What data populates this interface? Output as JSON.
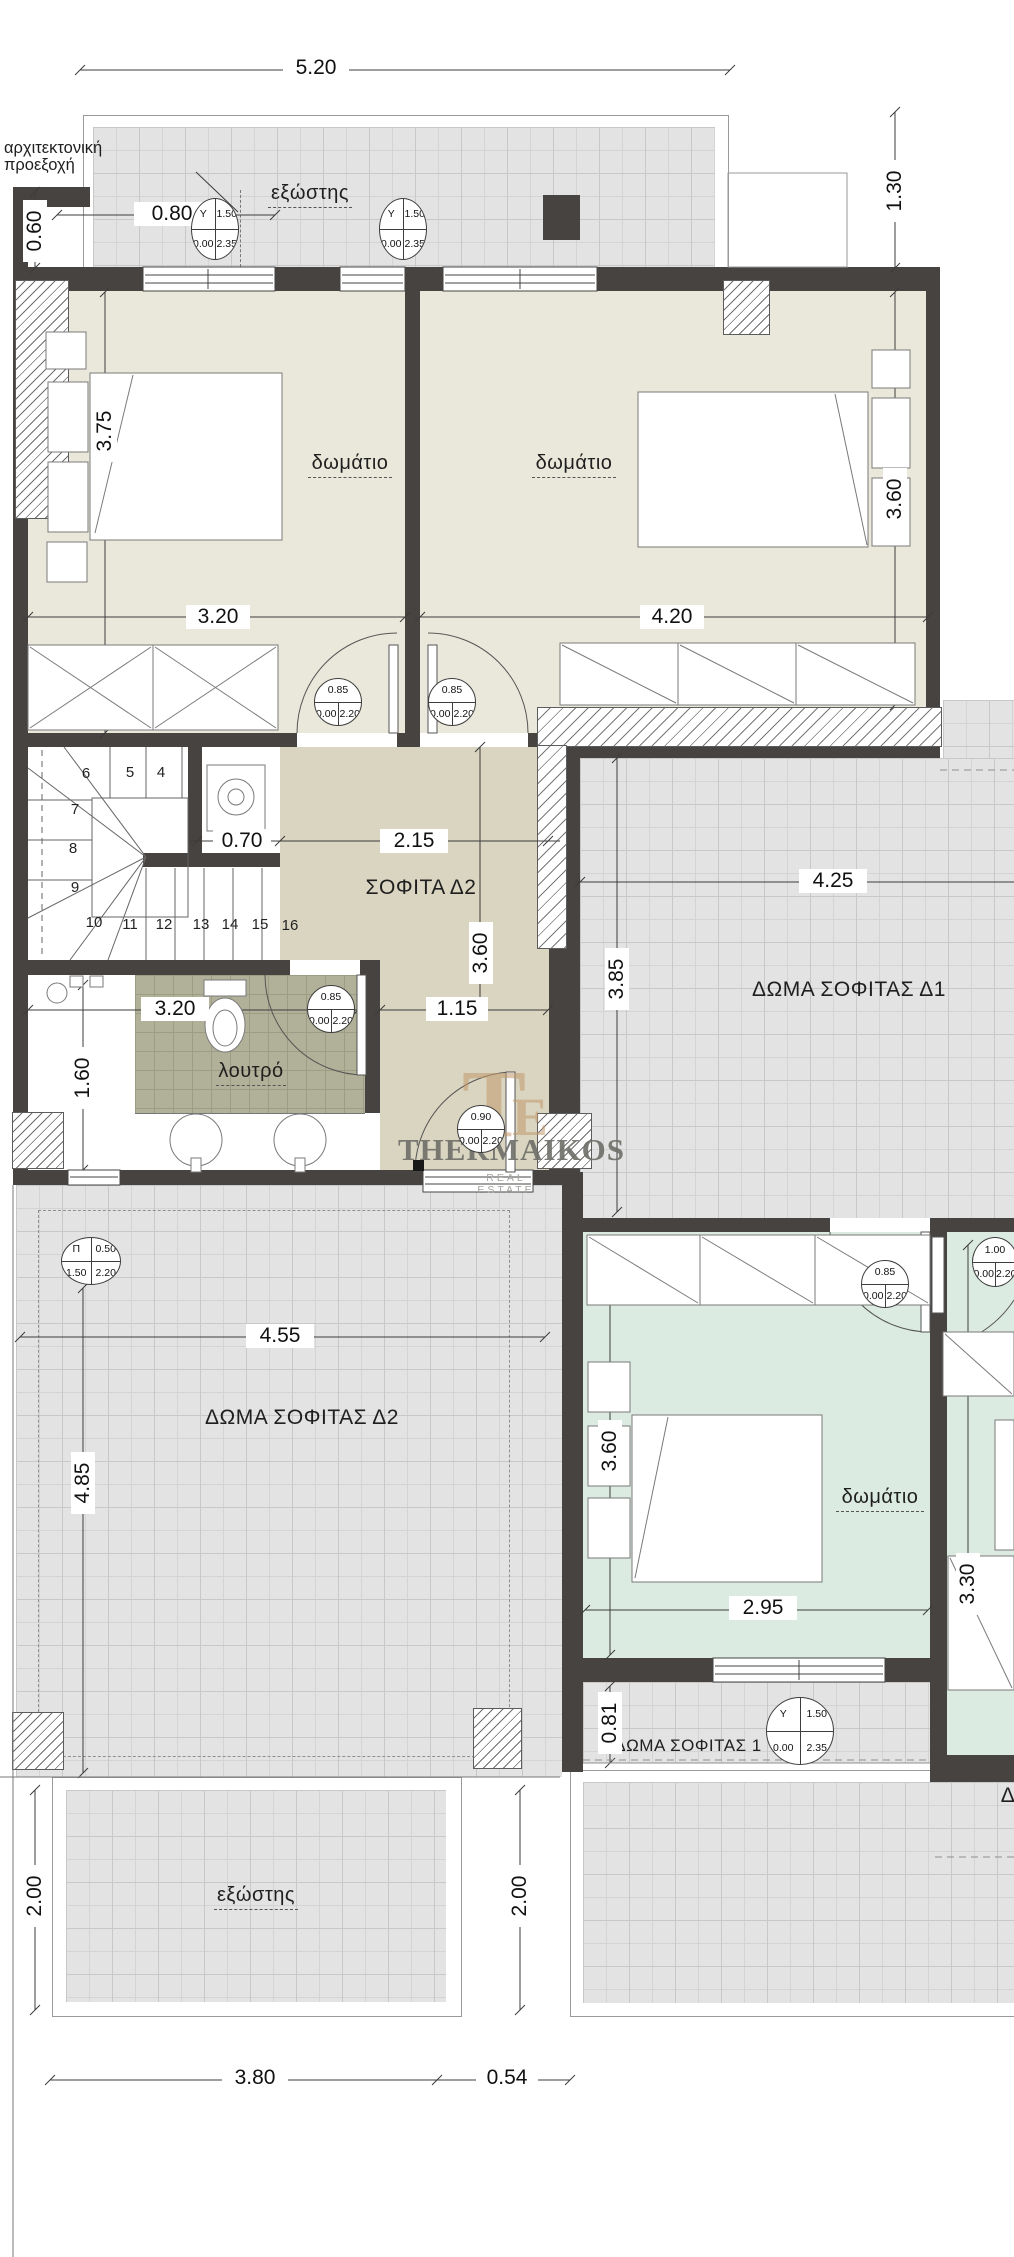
{
  "note": {
    "line1": "αρχιτεκτονική",
    "line2": "προεξοχή"
  },
  "rooms": {
    "balcony_top": "εξώστης",
    "bedroom1": "δωμάτιο",
    "bedroom2": "δωμάτιο",
    "loft": "ΣΟΦΙΤΑ Δ2",
    "roof_loft1": "ΔΩΜΑ ΣΟΦΙΤΑΣ Δ1",
    "bath": "λουτρό",
    "roof_loft2": "ΔΩΜΑ ΣΟΦΙΤΑΣ Δ2",
    "bedroom3": "δωμάτιο",
    "roof_loft3": "ΔΩΜΑ ΣΟΦΙΤΑΣ 1",
    "balcony_bottom": "εξώστης",
    "cut_label": "Δ"
  },
  "dims": {
    "w_total": "5.20",
    "h_right": "1.30",
    "proj_w": "0.80",
    "proj_h": "0.60",
    "bed1_h": "3.75",
    "bed1_w": "3.20",
    "bed2_w": "4.20",
    "bed2_h": "3.60",
    "stair_w": "0.70",
    "hall_w": "2.15",
    "hall_h": "3.60",
    "roof1_w": "4.25",
    "roof1_h": "3.85",
    "bath_w": "3.20",
    "bath_h": "1.60",
    "hall2_w": "1.15",
    "roof2_w": "4.55",
    "roof2_h": "4.85",
    "bed3_h": "3.60",
    "bed3_w": "2.95",
    "bed4_h": "3.30",
    "strip_h": "0.81",
    "balc_left": "2.00",
    "balc_right": "2.00",
    "bot_left": "3.80",
    "bot_right": "0.54"
  },
  "stairs": [
    "4",
    "5",
    "6",
    "7",
    "8",
    "9",
    "10",
    "11",
    "12",
    "13",
    "14",
    "15",
    "16"
  ],
  "circles": [
    {
      "t1": "Y",
      "t2": "1.50",
      "b1": "0.00",
      "b2": "2.35"
    },
    {
      "t1": "Y",
      "t2": "1.50",
      "b1": "0.00",
      "b2": "2.35"
    },
    {
      "t": "0.85",
      "b1": "0.00",
      "b2": "2.20"
    },
    {
      "t": "0.85",
      "b1": "0.00",
      "b2": "2.20"
    },
    {
      "t": "0.85",
      "b1": "0.00",
      "b2": "2.20"
    },
    {
      "t": "0.90",
      "b1": "0.00",
      "b2": "2.20"
    },
    {
      "t1": "Π",
      "t2": "0.50",
      "b1": "1.50",
      "b2": "2.20"
    },
    {
      "t": "0.85",
      "b1": "0.00",
      "b2": "2.20"
    },
    {
      "t": "1.00",
      "b1": "0.00",
      "b2": "2.20"
    },
    {
      "t1": "Y",
      "t2": "1.50",
      "b1": "0.00",
      "b2": "2.35"
    }
  ],
  "logo": {
    "name": "THERMAIKOS",
    "tagline": "REAL ESTATE",
    "mono_a": "T",
    "mono_b": "E"
  },
  "colors": {
    "wall": "#474340",
    "beige": "#eae8da",
    "olive": "#d9d5c1",
    "green": "#dcebe2",
    "tile": "#e3e3e3",
    "bath_tile": "#b1b098",
    "logo_tan": "#c3996b"
  }
}
